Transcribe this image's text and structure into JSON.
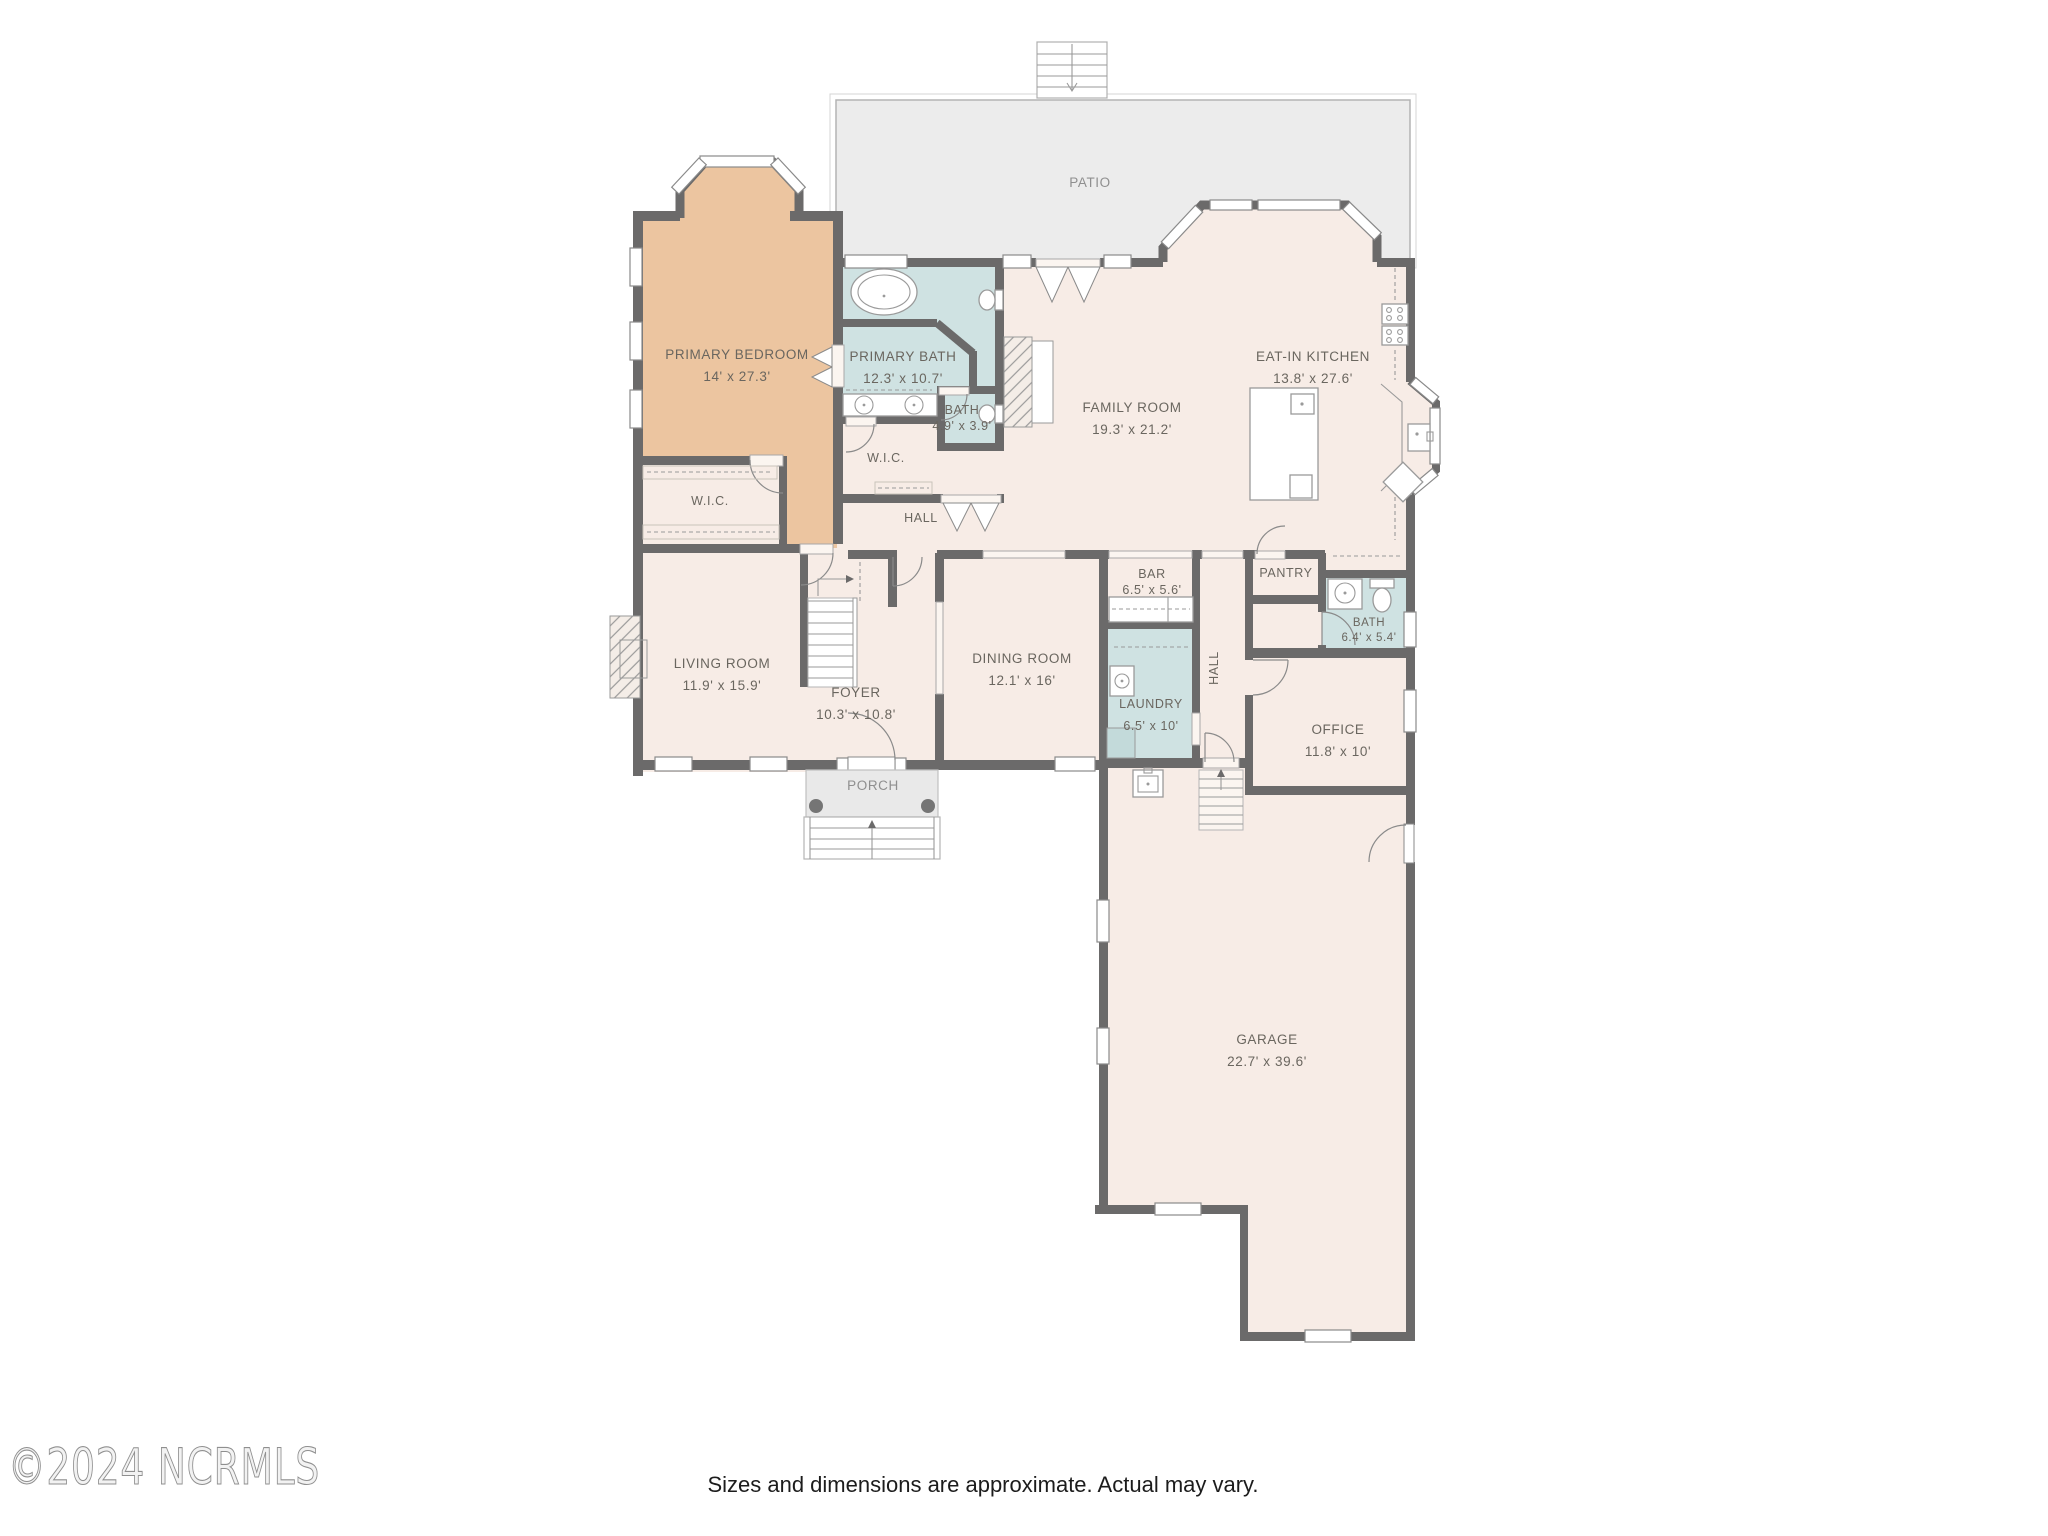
{
  "footer": {
    "watermark": "©2024 NCRMLS",
    "caption": "Sizes and dimensions are approximate. Actual may vary."
  },
  "rooms": {
    "patio": {
      "name": "PATIO"
    },
    "primary_bedroom": {
      "name": "PRIMARY BEDROOM",
      "dims": "14' x 27.3'"
    },
    "primary_bath": {
      "name": "PRIMARY BATH",
      "dims": "12.3' x 10.7'"
    },
    "bath_small": {
      "name": "BATH",
      "dims": "4.9' x 3.9'"
    },
    "wic_bedroom": {
      "name": "W.I.C."
    },
    "wic_hall": {
      "name": "W.I.C."
    },
    "hall_upper": {
      "name": "HALL"
    },
    "family_room": {
      "name": "FAMILY ROOM",
      "dims": "19.3' x 21.2'"
    },
    "eat_in_kitchen": {
      "name": "EAT-IN KITCHEN",
      "dims": "13.8' x 27.6'"
    },
    "living_room": {
      "name": "LIVING ROOM",
      "dims": "11.9' x 15.9'"
    },
    "foyer": {
      "name": "FOYER",
      "dims": "10.3' x 10.8'"
    },
    "dining_room": {
      "name": "DINING ROOM",
      "dims": "12.1' x 16'"
    },
    "bar": {
      "name": "BAR",
      "dims": "6.5' x 5.6'"
    },
    "laundry": {
      "name": "LAUNDRY",
      "dims": "6.5' x 10'"
    },
    "hall_lower": {
      "name": "HALL"
    },
    "pantry": {
      "name": "PANTRY"
    },
    "bath_hall": {
      "name": "BATH",
      "dims": "6.4' x 5.4'"
    },
    "office": {
      "name": "OFFICE",
      "dims": "11.8' x 10'"
    },
    "porch": {
      "name": "PORCH"
    },
    "garage": {
      "name": "GARAGE",
      "dims": "22.7' x 39.6'"
    }
  },
  "colors": {
    "walls": "#6b6a6a",
    "room_fill": "#f7ece6",
    "bedroom_fill": "#ecc5a0",
    "bath_fill": "#cfe2e2",
    "patio_fill": "#ececec",
    "porch_fill": "#e9e9e9",
    "column_fill": "#757575",
    "label_text": "#6a665f",
    "outdoor_label_text": "#8f8f8f"
  }
}
